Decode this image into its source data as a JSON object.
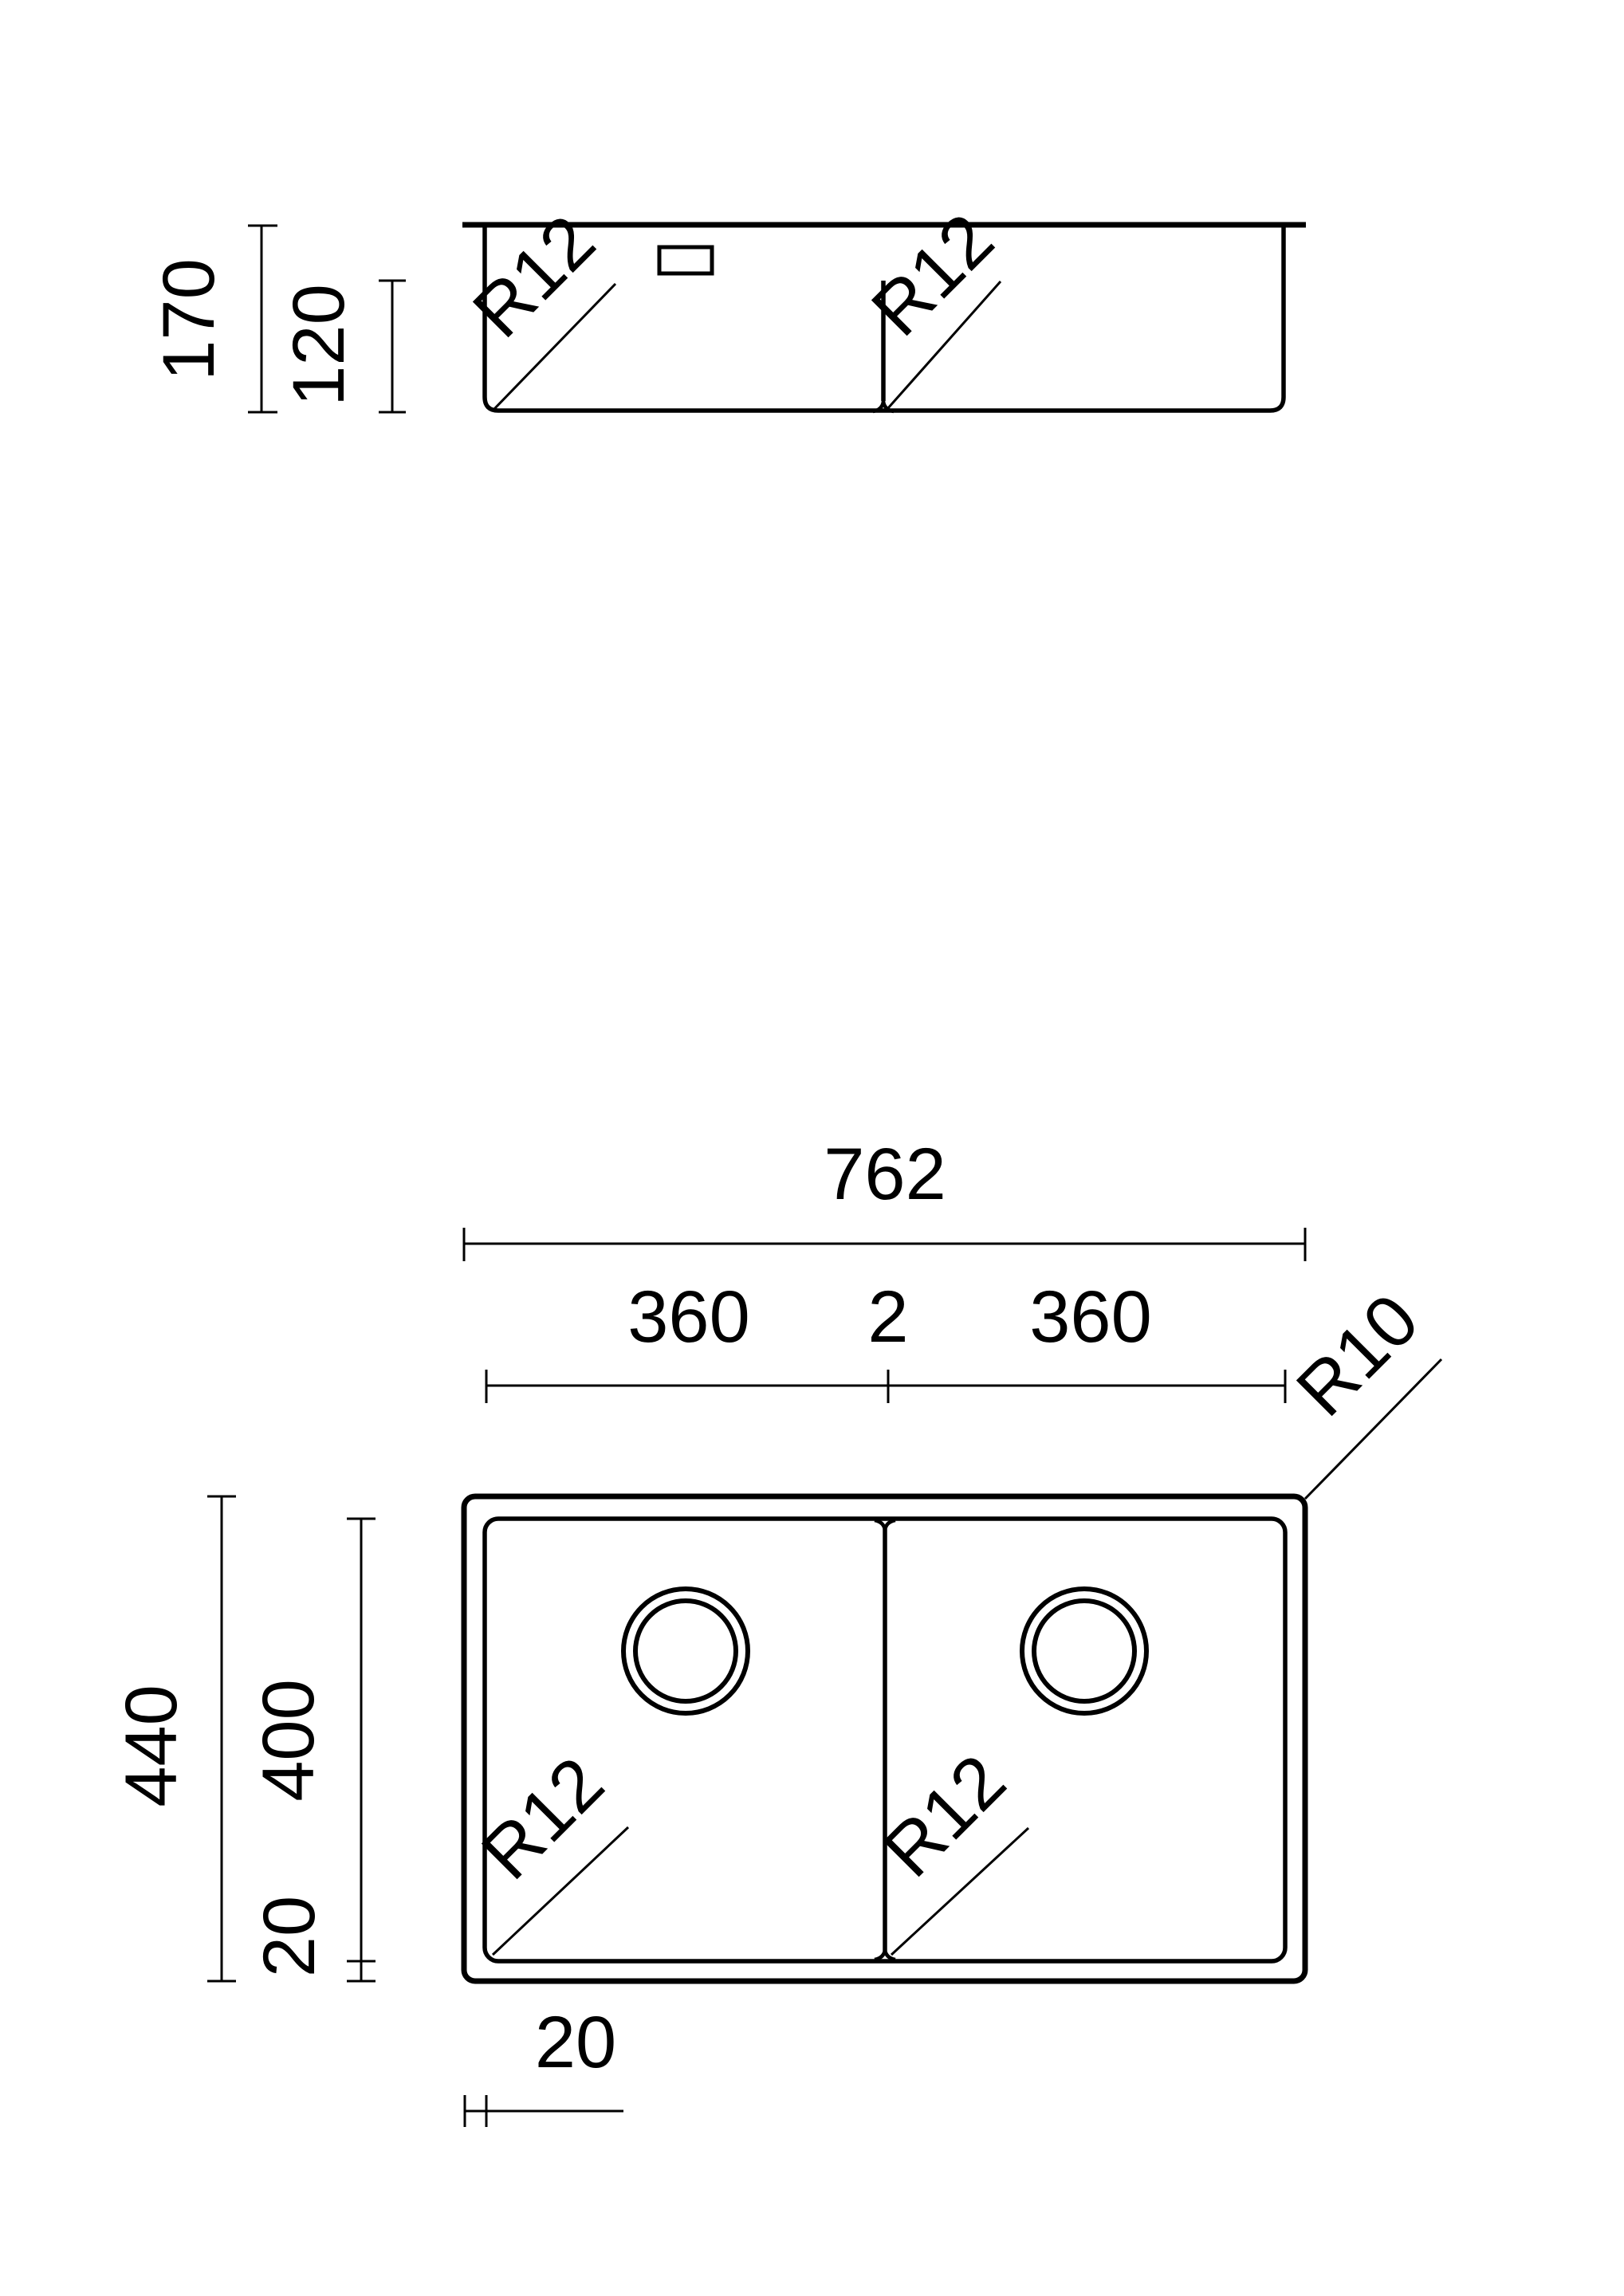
{
  "drawing": {
    "title": "double-bowl-sink-dimension-drawing",
    "colors": {
      "ink": "#000000",
      "background": "#ffffff"
    },
    "side_view": {
      "depth_total": "170",
      "divider_height": "120",
      "bowl_radius_left": "R12",
      "bowl_radius_right": "R12"
    },
    "plan_view": {
      "overall_width": "762",
      "bowl_width_left": "360",
      "divider_thickness": "2",
      "bowl_width_right": "360",
      "outer_corner_radius": "R10",
      "overall_depth": "440",
      "bowl_depth": "400",
      "rim_offset_bottom": "20",
      "rim_offset_left": "20",
      "bowl_radius_left": "R12",
      "bowl_radius_right": "R12"
    }
  }
}
